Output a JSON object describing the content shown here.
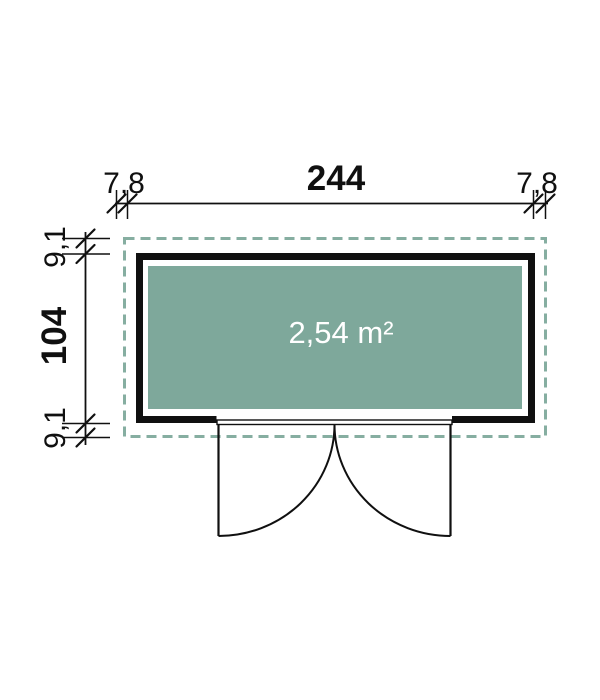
{
  "figure": {
    "area_label": "2,54 m²"
  },
  "dimensions": {
    "top": {
      "left_overhang": "7,8",
      "total_width": "244",
      "right_overhang": "7,8"
    },
    "left": {
      "top_overhang": "9,1",
      "total_depth": "104",
      "bottom_overhang": "9,1"
    }
  },
  "colors": {
    "floor_fill": "#7EA89B",
    "roof_dash": "#86AEA1",
    "line_black": "#101010",
    "area_text": "#FFFFFF"
  }
}
